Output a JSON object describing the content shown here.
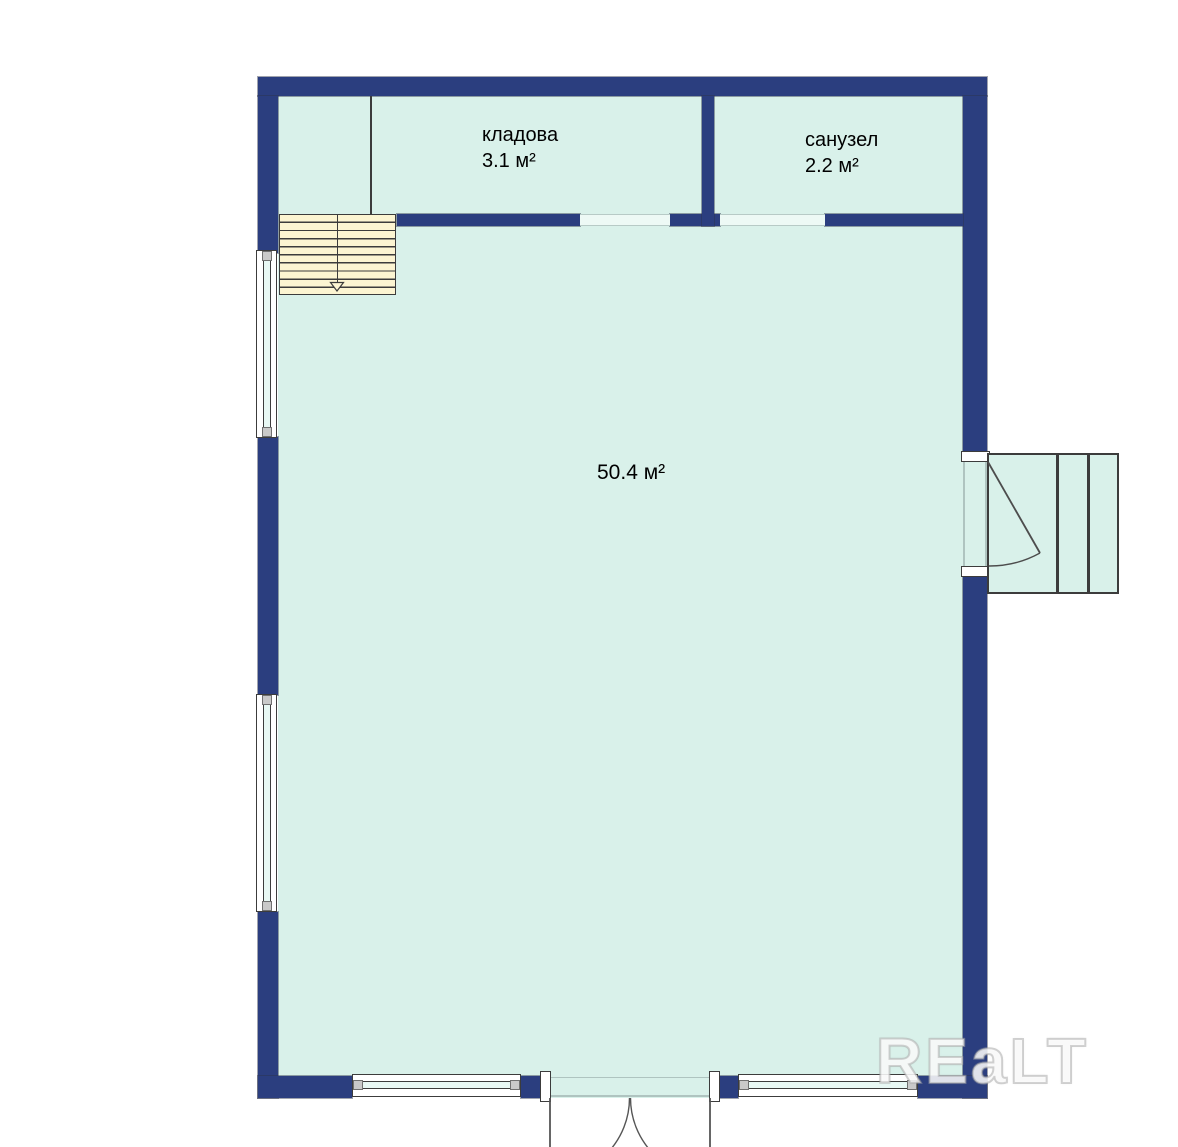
{
  "plan": {
    "rooms": [
      {
        "name": "кладова",
        "area": "3.1 м²"
      },
      {
        "name": "санузел",
        "area": "2.2 м²"
      },
      {
        "name": "",
        "area": "50.4 м²"
      }
    ],
    "watermark": "REaLT",
    "colors": {
      "wall": "#2B3E7F",
      "floor": "#D9F1EA",
      "stairs": "#FCF5D2",
      "outline": "#3C3C3C",
      "window_pane": "#E8F8F4"
    }
  }
}
